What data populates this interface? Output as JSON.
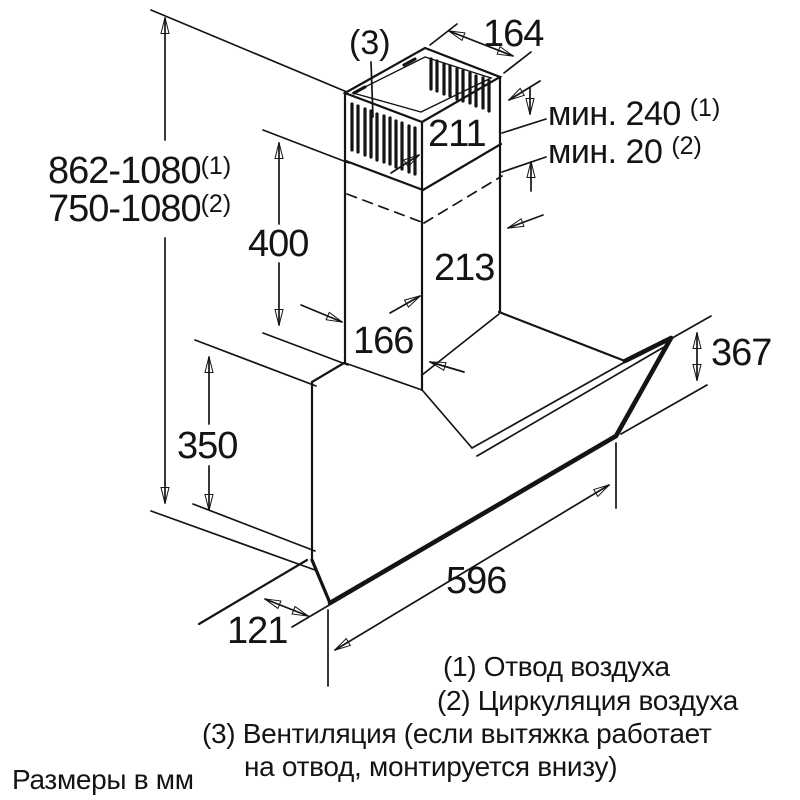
{
  "diagram": {
    "dimensions": {
      "height_range_1": "862-1080",
      "height_range_1_sup": "(1)",
      "height_range_2": "750-1080",
      "height_range_2_sup": "(2)",
      "chimney_section_height": "400",
      "body_height": "350",
      "chimney_top_depth": "164",
      "chimney_top_width": "211",
      "chimney_lower_width": "213",
      "chimney_lower_depth": "166",
      "glass_front_height": "367",
      "hood_width": "596",
      "bottom_wall_gap": "121",
      "min_clearance_1": "мин. 240",
      "min_clearance_1_sup": "(1)",
      "min_clearance_2": "мин. 20",
      "min_clearance_2_sup": "(2)",
      "vent_ref": "(3)"
    },
    "legend": {
      "line1": "(1) Отвод воздуха",
      "line2": "(2) Циркуляция воздуха",
      "line3": "(3) Вентиляция (если вытяжка работает",
      "line4": "на отвод, монтируется внизу)"
    },
    "units_note": "Размеры в мм"
  }
}
